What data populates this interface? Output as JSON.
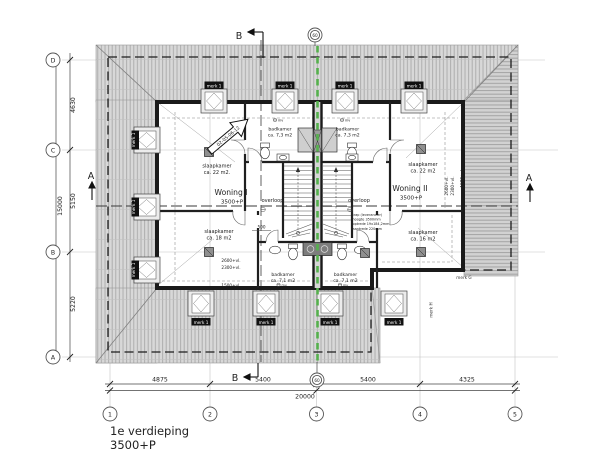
{
  "meta": {
    "title_line1": "1e verdieping",
    "title_line2": "3500+P"
  },
  "grid": {
    "cols": [
      "1",
      "2",
      "3",
      "4",
      "5"
    ],
    "rows": [
      "D",
      "C",
      "B",
      "A"
    ],
    "party_bubble": "60"
  },
  "dimensions": {
    "bottom_segments": [
      "4875",
      "5400",
      "5400",
      "4325"
    ],
    "bottom_total": "20000",
    "left_segments": [
      "4630",
      "5150",
      "5220"
    ],
    "left_total": "15000",
    "stair_width": "500"
  },
  "sections": {
    "a": "A",
    "b": "B"
  },
  "units": {
    "woning1_name": "Woning I",
    "woning1_level": "3500+P",
    "woning2_name": "Woning II",
    "woning2_level": "3500+P"
  },
  "rooms": {
    "slaapkamer": "slaapkamer",
    "area_22_dot": "ca. 22 m2.",
    "area_22": "ca. 22 m2",
    "area_18": "ca. 18 m2",
    "area_16": "ca. 16 m2",
    "badkamer": "badkamer",
    "area_7_3": "ca. 7,3 m2",
    "area_7_1": "ca. 7,1 m2",
    "overloop": "overloop",
    "mv": "mv"
  },
  "levels": {
    "l2600": "2600+vl.",
    "l2300": "2300+vl.",
    "l1500": "1500+vl."
  },
  "marks": {
    "merk1": "merk 1",
    "merkG": "merk G",
    "merkH": "merk H"
  },
  "annotations": {
    "detail_ref": "02-05-06-12",
    "stair_note": [
      "trap (leverancier)",
      "hoogte 3500mm",
      "optrede 19x184,2mm",
      "aantrede 220mm"
    ]
  }
}
